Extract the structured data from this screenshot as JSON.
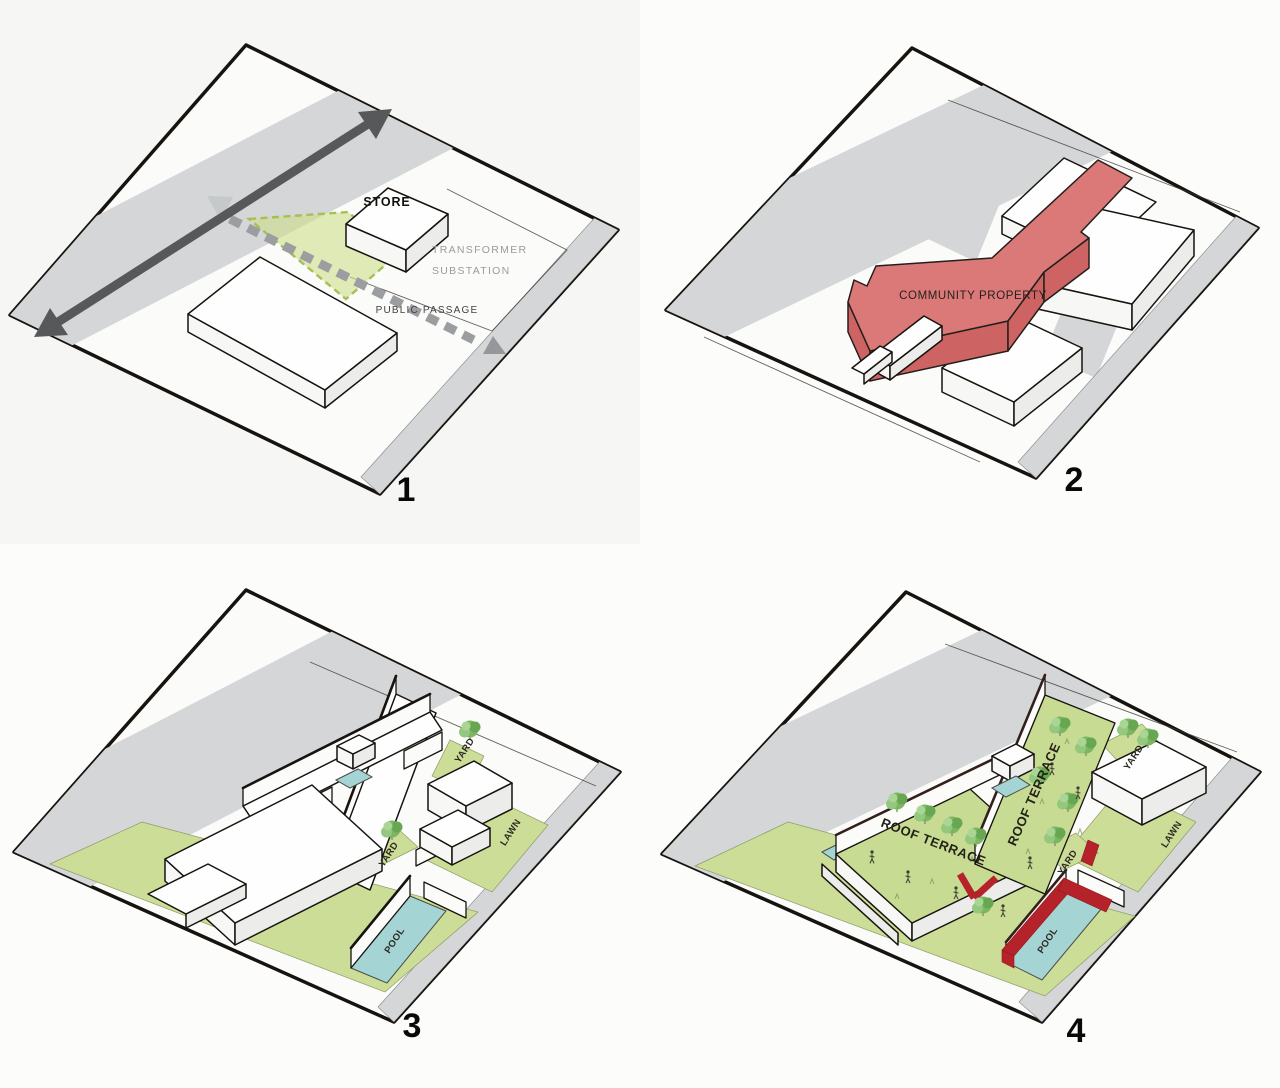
{
  "document": {
    "type": "architectural-concept-diagram-sheet",
    "panel_count": 4
  },
  "panels": [
    {
      "number": "1",
      "labels": {
        "store": "STORE",
        "transformer_line1": "TRANSFORMER",
        "transformer_line2": "SUBSTATION",
        "public_passage": "PUBLIC PASSAGE"
      }
    },
    {
      "number": "2",
      "labels": {
        "community_property": "COMMUNITY PROPERTY"
      }
    },
    {
      "number": "3",
      "labels": {
        "yard_upper": "YARD",
        "yard_middle": "YARD",
        "lawn": "LAWN",
        "pool": "POOL"
      }
    },
    {
      "number": "4",
      "labels": {
        "roof_terrace_left": "ROOF TERRACE",
        "roof_terrace_right": "ROOF TERRACE",
        "yard_upper": "YARD",
        "yard_middle": "YARD",
        "lawn": "LAWN",
        "pool": "POOL"
      }
    }
  ],
  "colors": {
    "background": "#fcfcfb",
    "panel1_background": "#f6f6f5",
    "site_fill": "#fbfbfa",
    "outline": "#17130e",
    "road_gray": "#d4d6d7",
    "direction_arrow": "#57585a",
    "dashed_passage_arrow": "#9b9ea0",
    "green_overlay": "#cdde8c",
    "green_ground": "#cbdd97",
    "pool_blue": "#a5d4d4",
    "red_building_top": "#db7878",
    "red_building_side": "#cd6363",
    "red_accent": "#b5222a",
    "tree_green": "#7cb662",
    "label_gray": "#9b9b9b",
    "label_dark": "#2d2a23"
  }
}
